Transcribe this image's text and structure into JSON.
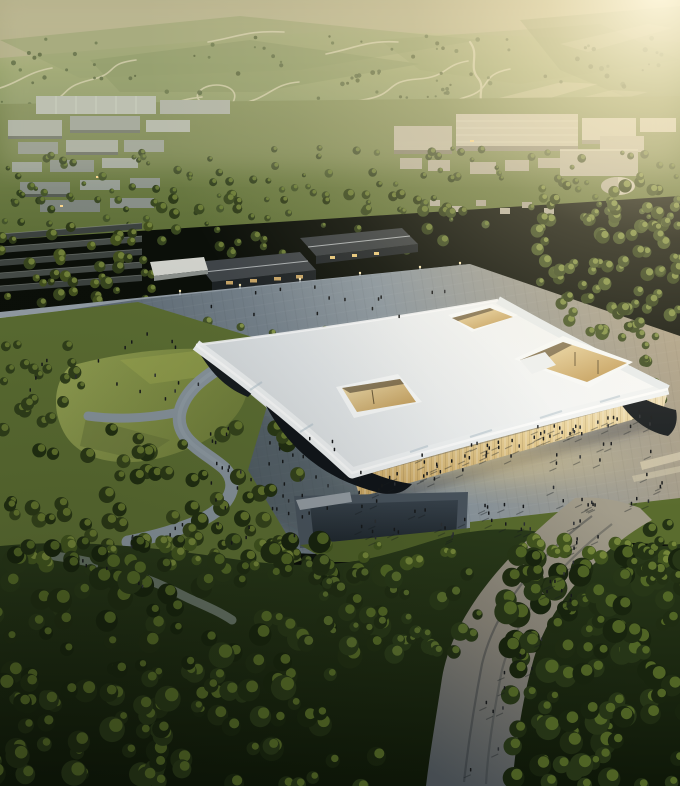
{
  "scene": {
    "description": "Aerial dusk rendering of an exhibition center with a floating white canopy roof pierced by courtyard openings, glowing glass facades, surrounding plazas with crowds, parkland, reflecting pools, dense forest with a pedestrian path, and a hillside campus with winding roads under warm evening light",
    "regions": [
      {
        "name": "hillside",
        "label": "hazy green mountainside with switchback roads"
      },
      {
        "name": "campus-district",
        "label": "low gray campus and warehouse buildings among trees"
      },
      {
        "name": "entry-pavilions",
        "label": "dark-roofed entry pavilions along an access road"
      },
      {
        "name": "exhibition-hall",
        "label": "white canopy-roof exhibition hall with courtyard openings"
      },
      {
        "name": "plaza",
        "label": "stone plaza with scattered visitors"
      },
      {
        "name": "park",
        "label": "lawn and winding park paths"
      },
      {
        "name": "forest",
        "label": "dense dark forest with pedestrian path"
      }
    ]
  },
  "palette": {
    "hill_light": "#c4bd95",
    "hill_mid": "#95a169",
    "hill_dark": "#6f7f4e",
    "hill_road": "#d9d3b2",
    "valley_green": "#6d7b46",
    "campus_gray": "#a3a99e",
    "warehouse_tan": "#c8c2ae",
    "roof_white": "#f4f6f6",
    "fascia_white": "#eef1f2",
    "facade_glow": "#e8d096",
    "interior_warm": "#c89e5c",
    "support_dark": "#161b1f",
    "plaza_warm": "#ab9f87",
    "plaza_cool": "#57646f",
    "pond_blue": "#2c3843",
    "pool_dark": "#232c34",
    "lawn_green": "#87954a",
    "park_green": "#5d6f33",
    "forest_dark": "#1c2912",
    "forest_highlight": "#5b7029",
    "path_light": "#a39d8b",
    "path_dark": "#4d545a",
    "people_dark": "#17191b",
    "sun_glow": "#fff3d2"
  },
  "scatter": [
    {
      "layer": "hillTrees",
      "kind": "trees",
      "area": [
        0,
        36,
        680,
        104
      ],
      "count": 140,
      "r": [
        1,
        2.6
      ],
      "palette": [
        "#4a5a33",
        "#435229",
        "#55663a"
      ],
      "seed": 1,
      "op": 0.85
    },
    {
      "layer": "valleyTrees",
      "kind": "trees",
      "area": [
        0,
        148,
        680,
        78
      ],
      "count": 120,
      "r": [
        2,
        4.5
      ],
      "palette": [
        "#3c4a26",
        "#46562c",
        "#31401e"
      ],
      "hl": "#70823a",
      "seed": 2
    },
    {
      "layer": "groveRight",
      "kind": "trees",
      "area": [
        536,
        176,
        144,
        158
      ],
      "count": 95,
      "r": [
        4,
        7
      ],
      "palette": [
        "#3b4a22",
        "#445426",
        "#2f3d19"
      ],
      "hl": "#8a9a4a",
      "seed": 3
    },
    {
      "layer": "leftBand",
      "kind": "trees",
      "area": [
        0,
        226,
        155,
        102
      ],
      "count": 48,
      "r": [
        3.5,
        6.5
      ],
      "palette": [
        "#39471f",
        "#2e3a19",
        "#44521f"
      ],
      "hl": "#7d8d41",
      "seed": 4
    },
    {
      "layer": "behindPavilions",
      "kind": "trees",
      "area": [
        148,
        194,
        330,
        60
      ],
      "count": 42,
      "r": [
        3,
        6
      ],
      "palette": [
        "#3a4921",
        "#2f3c1a"
      ],
      "hl": "#76863c",
      "seed": 5
    },
    {
      "layer": "roadRow",
      "kind": "treesLine",
      "line": [
        142,
        312,
        468,
        280
      ],
      "jitter": 5,
      "count": 22,
      "r": [
        4,
        6
      ],
      "palette": [
        "#3f5124"
      ],
      "hl": "#8a9a4a",
      "seed": 6
    },
    {
      "layer": "plazaTrees",
      "kind": "trees",
      "area": [
        205,
        320,
        230,
        24
      ],
      "count": 10,
      "r": [
        3,
        5
      ],
      "palette": [
        "#45552a"
      ],
      "hl": "#93a351",
      "seed": 7
    },
    {
      "layer": "plazaTreesRight",
      "kind": "trees",
      "area": [
        600,
        330,
        80,
        70
      ],
      "count": 14,
      "r": [
        3.5,
        6
      ],
      "palette": [
        "#3b4a22"
      ],
      "hl": "#8a9a4a",
      "seed": 8
    },
    {
      "layer": "parkTrees",
      "kind": "trees",
      "area": [
        0,
        425,
        300,
        150
      ],
      "count": 75,
      "r": [
        5,
        9
      ],
      "palette": [
        "#2c3a17",
        "#36451c",
        "#223012"
      ],
      "hl": "#708234",
      "seed": 9
    },
    {
      "layer": "leftEdgeTrees",
      "kind": "trees",
      "area": [
        0,
        330,
        85,
        100
      ],
      "count": 22,
      "r": [
        4,
        7
      ],
      "palette": [
        "#31401b"
      ],
      "hl": "#6f8136",
      "seed": 10
    },
    {
      "layer": "forest1",
      "kind": "trees",
      "area": [
        -10,
        540,
        400,
        250
      ],
      "count": 170,
      "r": [
        6,
        13
      ],
      "palette": [
        "#1f2c12",
        "#273617",
        "#18240e"
      ],
      "hl": "#5b7029",
      "seed": 11
    },
    {
      "layer": "forest2",
      "kind": "trees",
      "area": [
        505,
        555,
        185,
        235
      ],
      "count": 110,
      "r": [
        6,
        13
      ],
      "palette": [
        "#1f2c12",
        "#273617",
        "#18240e"
      ],
      "hl": "#5b7029",
      "seed": 12
    },
    {
      "layer": "forest3",
      "kind": "trees",
      "area": [
        300,
        560,
        185,
        95
      ],
      "count": 40,
      "r": [
        5,
        10
      ],
      "palette": [
        "#202d13",
        "#283818"
      ],
      "hl": "#5f7430",
      "seed": 13
    },
    {
      "layer": "forest4",
      "kind": "trees",
      "area": [
        630,
        524,
        50,
        60
      ],
      "count": 14,
      "r": [
        5,
        9
      ],
      "palette": [
        "#233114"
      ],
      "hl": "#6a7e33",
      "seed": 14
    },
    {
      "layer": "forestHlLeft",
      "kind": "trees",
      "area": [
        0,
        540,
        470,
        26
      ],
      "count": 30,
      "r": [
        4,
        8
      ],
      "palette": [
        "#42551f"
      ],
      "hl": "#7c8f3e",
      "seed": 15
    },
    {
      "layer": "forestHlRight",
      "kind": "trees",
      "area": [
        505,
        540,
        175,
        26
      ],
      "count": 16,
      "r": [
        4,
        8
      ],
      "palette": [
        "#42551f"
      ],
      "hl": "#7c8f3e",
      "seed": 16
    },
    {
      "layer": "peopleLayer",
      "kind": "peopleLine",
      "line": [
        362,
        486,
        655,
        408
      ],
      "jitter": 12,
      "count": 48,
      "shadow": true,
      "seed": 21
    },
    {
      "layer": "peopleLayer",
      "kind": "people",
      "area": [
        210,
        430,
        150,
        120
      ],
      "count": 45,
      "shadow": false,
      "seed": 22
    },
    {
      "layer": "peopleLayer",
      "kind": "people",
      "area": [
        360,
        500,
        180,
        40
      ],
      "count": 25,
      "shadow": true,
      "seed": 23
    },
    {
      "layer": "peopleLayer",
      "kind": "people",
      "area": [
        545,
        415,
        130,
        95
      ],
      "count": 26,
      "shadow": true,
      "seed": 24
    },
    {
      "layer": "peopleLayer",
      "kind": "peopleLine",
      "line": [
        598,
        516,
        470,
        770
      ],
      "jitter": 16,
      "count": 24,
      "shadow": true,
      "seed": 25
    },
    {
      "layer": "peopleLayer",
      "kind": "people",
      "area": [
        30,
        330,
        170,
        75
      ],
      "count": 18,
      "shadow": false,
      "seed": 26
    },
    {
      "layer": "peopleLayer",
      "kind": "people",
      "area": [
        210,
        288,
        260,
        34
      ],
      "count": 14,
      "shadow": false,
      "seed": 27
    },
    {
      "layer": "peopleLayer",
      "kind": "peopleLine",
      "line": [
        196,
        526,
        130,
        544
      ],
      "jitter": 6,
      "count": 6,
      "shadow": false,
      "seed": 28
    },
    {
      "layer": "peopleLayer",
      "kind": "peopleLine",
      "line": [
        60,
        556,
        185,
        596
      ],
      "jitter": 5,
      "count": 5,
      "shadow": false,
      "seed": 29
    }
  ]
}
